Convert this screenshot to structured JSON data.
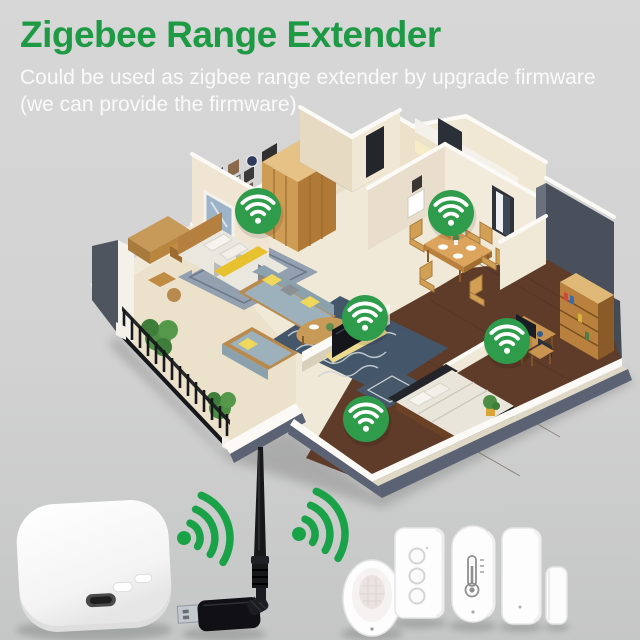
{
  "header": {
    "title": "Zigebee Range Extender",
    "subtitle_line1": "Could be used as zigbee range extender by upgrade firmware",
    "subtitle_line2": "(we can provide the firmware)"
  },
  "theme": {
    "background_top": "#d7d7d7",
    "background_bottom": "#c5c6c6",
    "title_color": "#1e9a45",
    "subtitle_color": "#fafafa",
    "wifi_badge_green": "#2f9c4c",
    "signal_arc_green": "#1aa248"
  },
  "house": {
    "wifi_coverage_points": [
      {
        "room": "master-bedroom",
        "x": 258,
        "y": 211
      },
      {
        "room": "dining-room",
        "x": 451,
        "y": 213
      },
      {
        "room": "living-room",
        "x": 365,
        "y": 318
      },
      {
        "room": "study",
        "x": 507,
        "y": 341
      },
      {
        "room": "second-bedroom",
        "x": 366,
        "y": 419
      }
    ]
  },
  "icons": {
    "wifi_badge": "white wifi arcs inside green circle",
    "signal_arcs": "green sideways wifi arcs with dot"
  },
  "product_icons": [
    "zigbee-gateway-hub",
    "usb-wifi-antenna",
    "pir-motion-sensor",
    "smart-wall-switch",
    "temperature-humidity-sensor",
    "door-window-sensor"
  ]
}
